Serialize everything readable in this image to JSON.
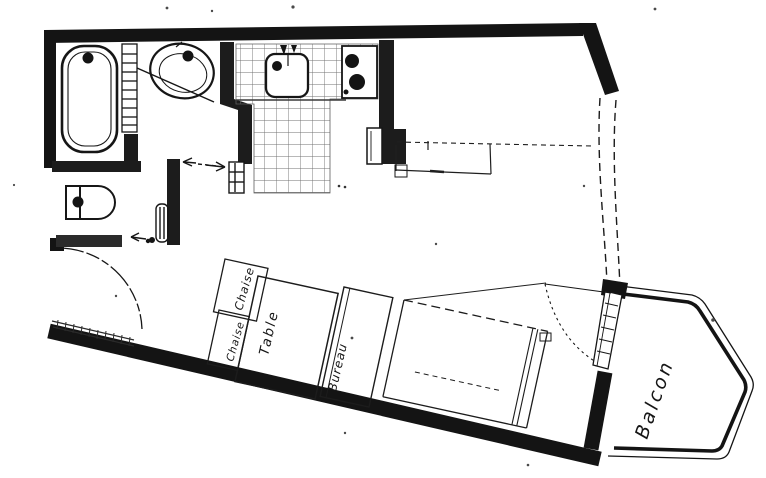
{
  "meta": {
    "kind": "scanned hand-drawn floor plan",
    "language": "fr"
  },
  "colors": {
    "ink": "#141414",
    "paper": "#ffffff",
    "tile_grid": "#6f6f6f"
  },
  "labels": {
    "chair_top": "Chaise",
    "chair_left": "Chaise",
    "table": "Table",
    "desk": "Bureau",
    "balcony": "Balcon"
  },
  "rooms": {
    "bathroom": {
      "fixtures": [
        "bathtub",
        "washbasin",
        "towel-rail"
      ]
    },
    "wc": {
      "fixtures": [
        "toilet",
        "radiator"
      ]
    },
    "kitchen": {
      "floor": "tiled",
      "fixtures": [
        "sink",
        "hob-two-burners",
        "fridge",
        "shelf"
      ]
    },
    "main_room": {
      "furniture": [
        "chair",
        "chair",
        "table",
        "desk",
        "bed",
        "wardrobe"
      ]
    },
    "balcony": {
      "shape": "pentagon-with-rounded-corners"
    }
  }
}
